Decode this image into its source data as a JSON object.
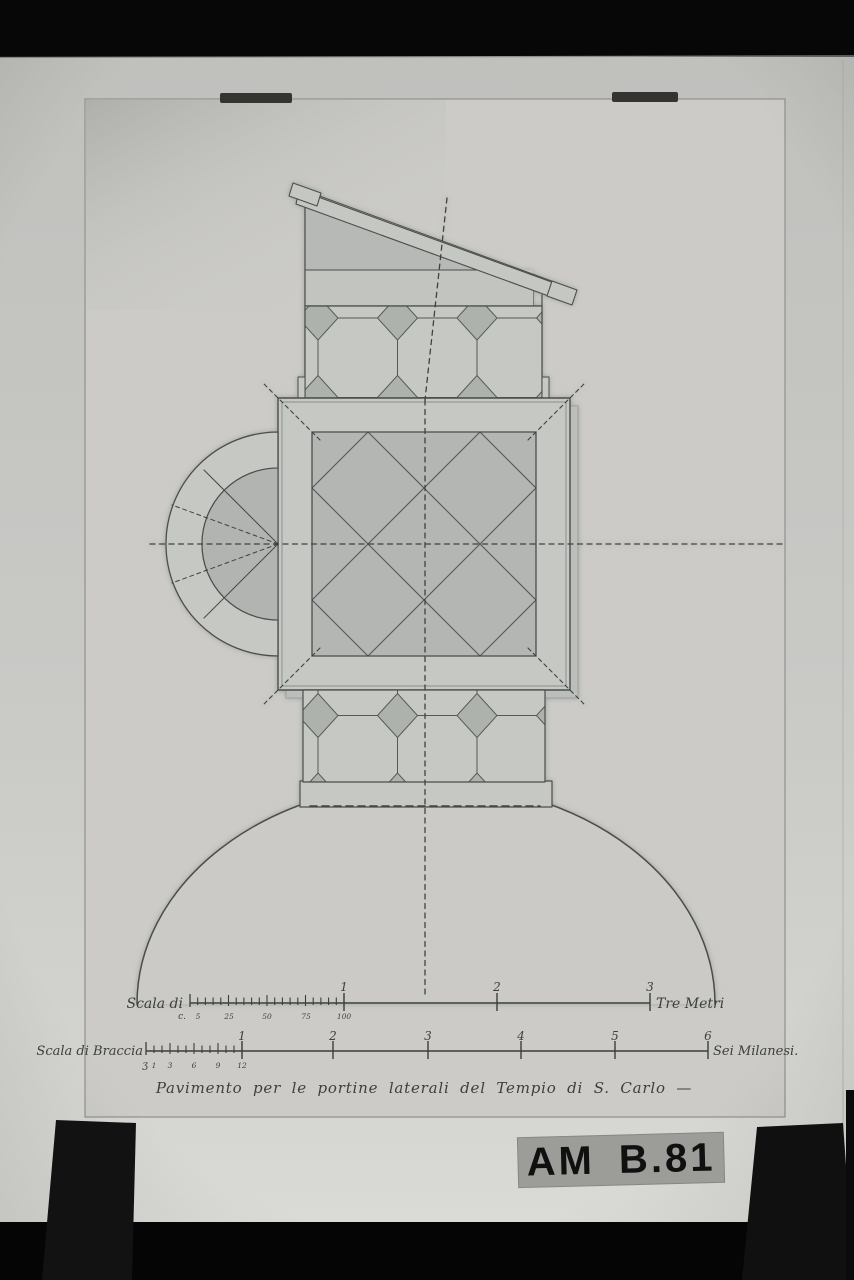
{
  "photo": {
    "archive_label": "AM B.81",
    "caption": "Pavimento per le portine laterali del Tempio di S. Carlo —"
  },
  "scale_metric": {
    "label_left": "Scala di",
    "label_right": "Tre Metri",
    "unit_prefix": "c.",
    "major_labels": [
      "1",
      "2",
      "3"
    ],
    "sub_labels": [
      "5",
      "25",
      "50",
      "75",
      "100"
    ]
  },
  "scale_braccia": {
    "label_left": "Scala di Braccia",
    "label_right": "Sei Milanesi.",
    "unit_prefix": "ʒ",
    "major_labels": [
      "1",
      "2",
      "3",
      "4",
      "5",
      "6"
    ],
    "sub_labels": [
      "1",
      "3",
      "6",
      "9",
      "12"
    ]
  },
  "colors": {
    "surround_black": "#070707",
    "backing_board": "#c6c6c3",
    "sheet_paper": "#cccbc7",
    "ink": "#4b4e4c",
    "tile_light": "#c6c8c4",
    "tile_dark": "#b0b3af",
    "label_strip": "#9c9c99"
  }
}
